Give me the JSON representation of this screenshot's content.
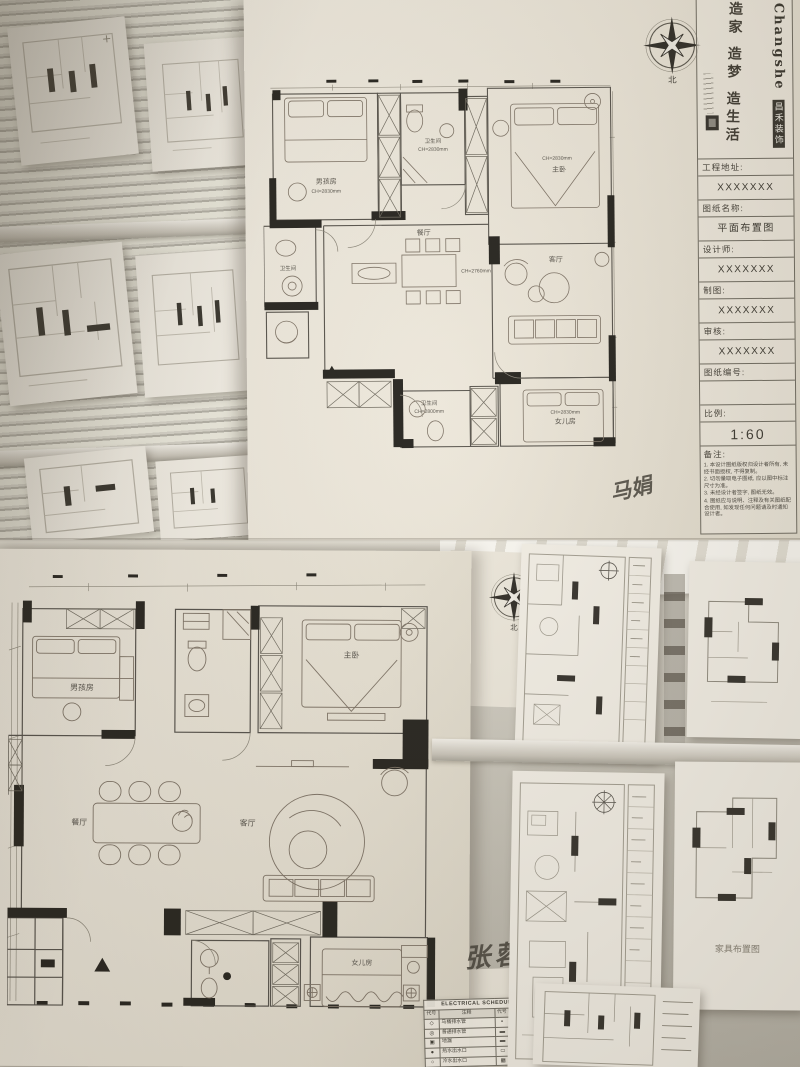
{
  "scene": {
    "north_label": "北"
  },
  "title_block": {
    "brand_en": "Changshe",
    "brand_cn": "昌禾装饰",
    "slogan": "造家 造梦 造生活",
    "fields": [
      {
        "label": "工程地址:",
        "value": "XXXXXXX"
      },
      {
        "label": "图纸名称:",
        "value": "平面布置图"
      },
      {
        "label": "设计师:",
        "value": "XXXXXXX"
      },
      {
        "label": "制图:",
        "value": "XXXXXXX"
      },
      {
        "label": "审核:",
        "value": "XXXXXXX"
      },
      {
        "label": "图纸编号:",
        "value": ""
      },
      {
        "label": "比例:",
        "value": "1:60"
      }
    ],
    "notes_label": "备注:",
    "notes": [
      "1. 本设计图纸版权归设计者所有, 未经书面授权, 不得复制。",
      "2. 切勿量取电子图纸, 应以图中标注尺寸为准。",
      "3. 未经设计者签字, 图纸无效。",
      "4. 图纸应与说明、注释及有关图纸配合使用, 如发现任何问题请及时通知设计者。"
    ]
  },
  "plan_top": {
    "rooms": {
      "boy": {
        "name": "男孩房",
        "ch": "CH=2830mm"
      },
      "bath_top": {
        "name": "卫生间",
        "ch": "CH=2830mm"
      },
      "master": {
        "name": "主卧",
        "ch": "CH=2830mm"
      },
      "dining": {
        "name": "餐厅",
        "ch": "CH=2760mm"
      },
      "living": {
        "name": "客厅"
      },
      "bath_left": {
        "name": "卫生间"
      },
      "bath_bottom": {
        "name": "卫生间",
        "ch": "CH=2800mm"
      },
      "daughter": {
        "name": "女儿房",
        "ch": "CH=2830mm"
      }
    },
    "signature": "马娟"
  },
  "plan_bottom": {
    "rooms": {
      "boy": {
        "name": "男孩房"
      },
      "master": {
        "name": "主卧"
      },
      "dining": {
        "name": "餐厅"
      },
      "living": {
        "name": "客厅"
      },
      "daughter": {
        "name": "女儿房"
      }
    },
    "signature": "张蓉"
  },
  "electrical_schedule": {
    "title": "ELECTRICAL SCHEDULE/家装图例表",
    "headers": [
      "代号",
      "注释",
      "代号",
      "注释"
    ],
    "rows": [
      {
        "s1": "◇",
        "t1": "马桶排水管",
        "s2": "▪",
        "t2": "分水器"
      },
      {
        "s1": "◎",
        "t1": "普通排水管",
        "s2": "▬",
        "t2": "浴霸"
      },
      {
        "s1": "▣",
        "t1": "地漏",
        "s2": "▬",
        "t2": "暖气"
      },
      {
        "s1": "●",
        "t1": "热水出水口",
        "s2": "▭",
        "t2": "燃气"
      },
      {
        "s1": "○",
        "t1": "冷水出水口",
        "s2": "▦",
        "t2": "普通配电箱"
      }
    ]
  },
  "right_sheets": {
    "furniture_plan_label": "家具布置图"
  }
}
